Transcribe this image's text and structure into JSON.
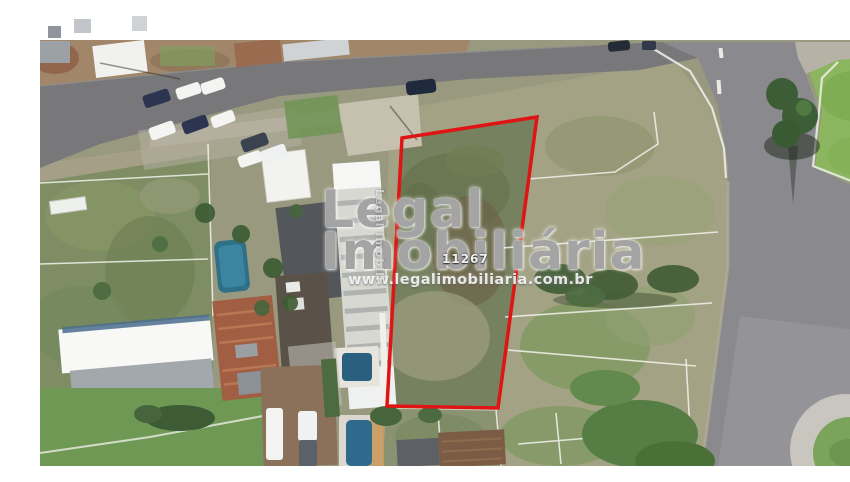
{
  "photo": {
    "kind": "aerial satellite view of land parcel",
    "listing_number": "11267"
  },
  "watermark": {
    "brand_line1": "Legal",
    "brand_line2": "Imobiliária",
    "website": "www.legalimobiliaria.com.br",
    "vertical_text": "Legal Imobiliária"
  },
  "parcel": {
    "points": "362,122 497,101 458,392 347,390",
    "stroke_width": "3.5"
  },
  "colors": {
    "parcel_outline": "#df1414",
    "watermark_text": "#929292",
    "road_asphalt": "#78787b",
    "road_asphalt_right": "#8a8a8e",
    "scrub": "#a3a284",
    "grass": "#7e8d63",
    "lawn": "#8cb55f",
    "pool": "#2f7087",
    "pool_bright": "#2f6a8d",
    "terracotta_roof": "#a25e42",
    "warehouse_roof": "#f8f8f6",
    "frame_background": "#ffffff"
  }
}
